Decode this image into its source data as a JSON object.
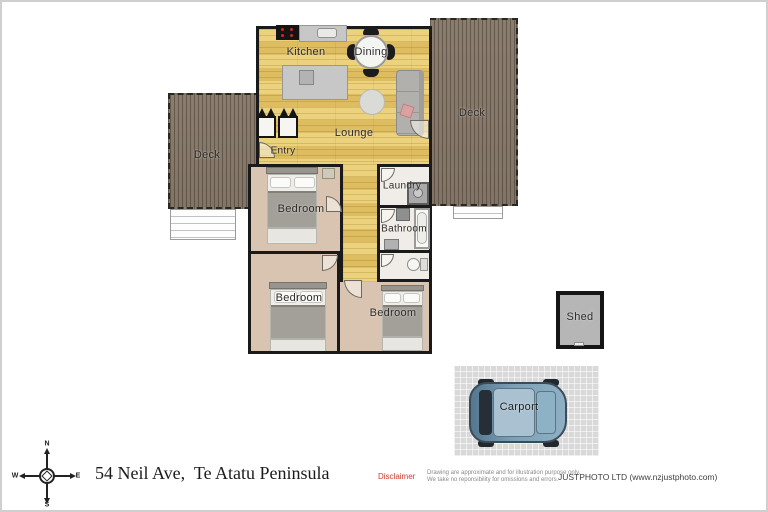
{
  "plan": {
    "rooms": {
      "kitchen": "Kitchen",
      "dining": "Dining",
      "lounge": "Lounge",
      "entry": "Entry",
      "deck_left": "Deck",
      "deck_right": "Deck",
      "laundry": "Laundry",
      "bathroom": "Bathroom",
      "bedroom_front": "Bedroom",
      "bedroom_mid": "Bedroom",
      "bedroom_back": "Bedroom",
      "shed": "Shed",
      "carport": "Carport"
    }
  },
  "compass": {
    "n": "N",
    "e": "E",
    "s": "S",
    "w": "W"
  },
  "footer": {
    "address": "54 Neil Ave,  Te Atatu Peninsula",
    "disclaimer_label": "Disclaimer",
    "disclaimer_line1": "Drawing are approximate and for illustration purpose only.",
    "disclaimer_line2": "We take no reponsibility for omissions and errors.",
    "credit": "JUSTPHOTO LTD (www.nzjustphoto.com)"
  },
  "colors": {
    "floor_wood": "#e3c76f",
    "deck_wood": "#87796a",
    "wall": "#1a1a1a",
    "carpet": "#d8c4b1",
    "wet_floor": "#f0ede8",
    "disclaimer_red": "#cc3b2f",
    "car_blue": "#7396ad"
  }
}
